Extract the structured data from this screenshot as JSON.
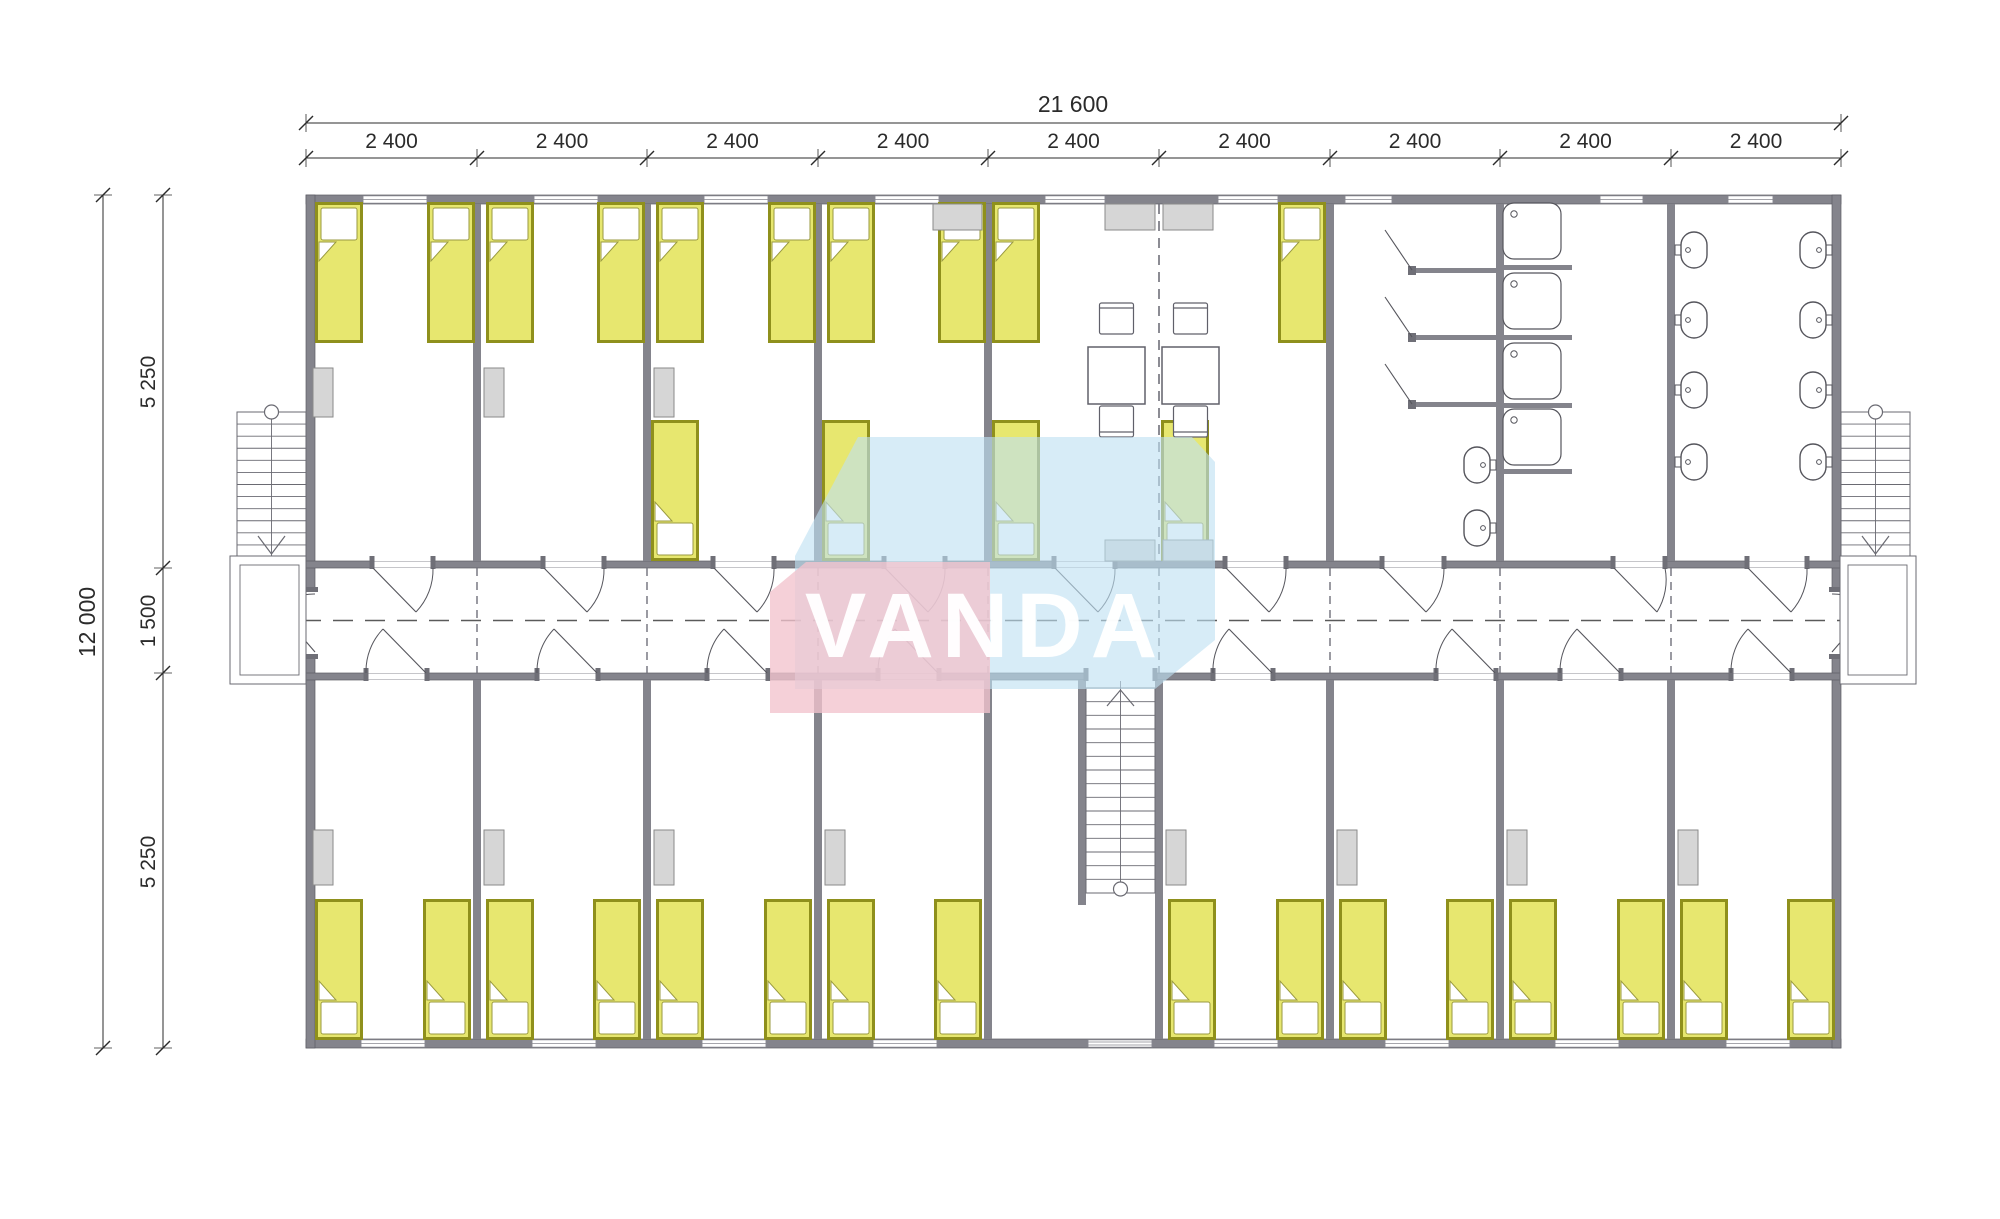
{
  "dimensions": {
    "top_total": "21 600",
    "module_width": "2 400",
    "module_count": 9,
    "left_total": "12 000",
    "left_segments": [
      "5 250",
      "1 500",
      "5 250"
    ]
  },
  "watermark": {
    "text": "VANDA",
    "pink_color": "#f2c3cd",
    "blue_color": "#bfe1f2"
  },
  "colors": {
    "wall": "#84848c",
    "wall_dark": "#6f6f77",
    "bed_fill": "#e7e76f",
    "bed_stroke": "#8f901c",
    "furniture_fill": "#d6d6d6",
    "furniture_stroke": "#8a8a8a",
    "line": "#4d4d55",
    "dimension": "#2b2b2b"
  },
  "fixture_names": [
    "bed",
    "wardrobe",
    "kitchen-counter",
    "dining-table",
    "chair",
    "shower-stall",
    "shower-tray",
    "wc-fixture",
    "stair",
    "landing",
    "window",
    "door"
  ]
}
